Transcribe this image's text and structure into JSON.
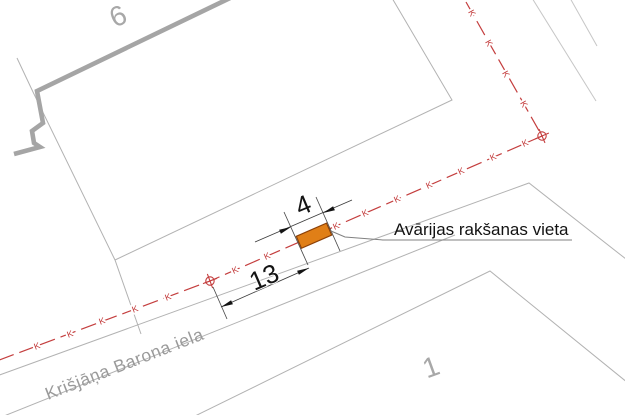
{
  "drawing": {
    "labels": {
      "building_number": "6",
      "parcel_number": "1",
      "street_name": "Krišjāņa Barona iela",
      "annotation": "Avārijas rakšanas vieta",
      "dim_excavation_length": "4",
      "dim_offset_to_manhole": "13",
      "utility_letter": "K"
    },
    "colors": {
      "utility_red": "#c43e3e",
      "excavation_fill": "#e07f17",
      "excavation_border": "#8c4007",
      "boundary_gray": "#b2b2b2",
      "building_gray": "#a5a5a5",
      "label_gray": "#a8a8a8",
      "dimension_black": "#141414",
      "leader_gray": "#818181"
    }
  }
}
